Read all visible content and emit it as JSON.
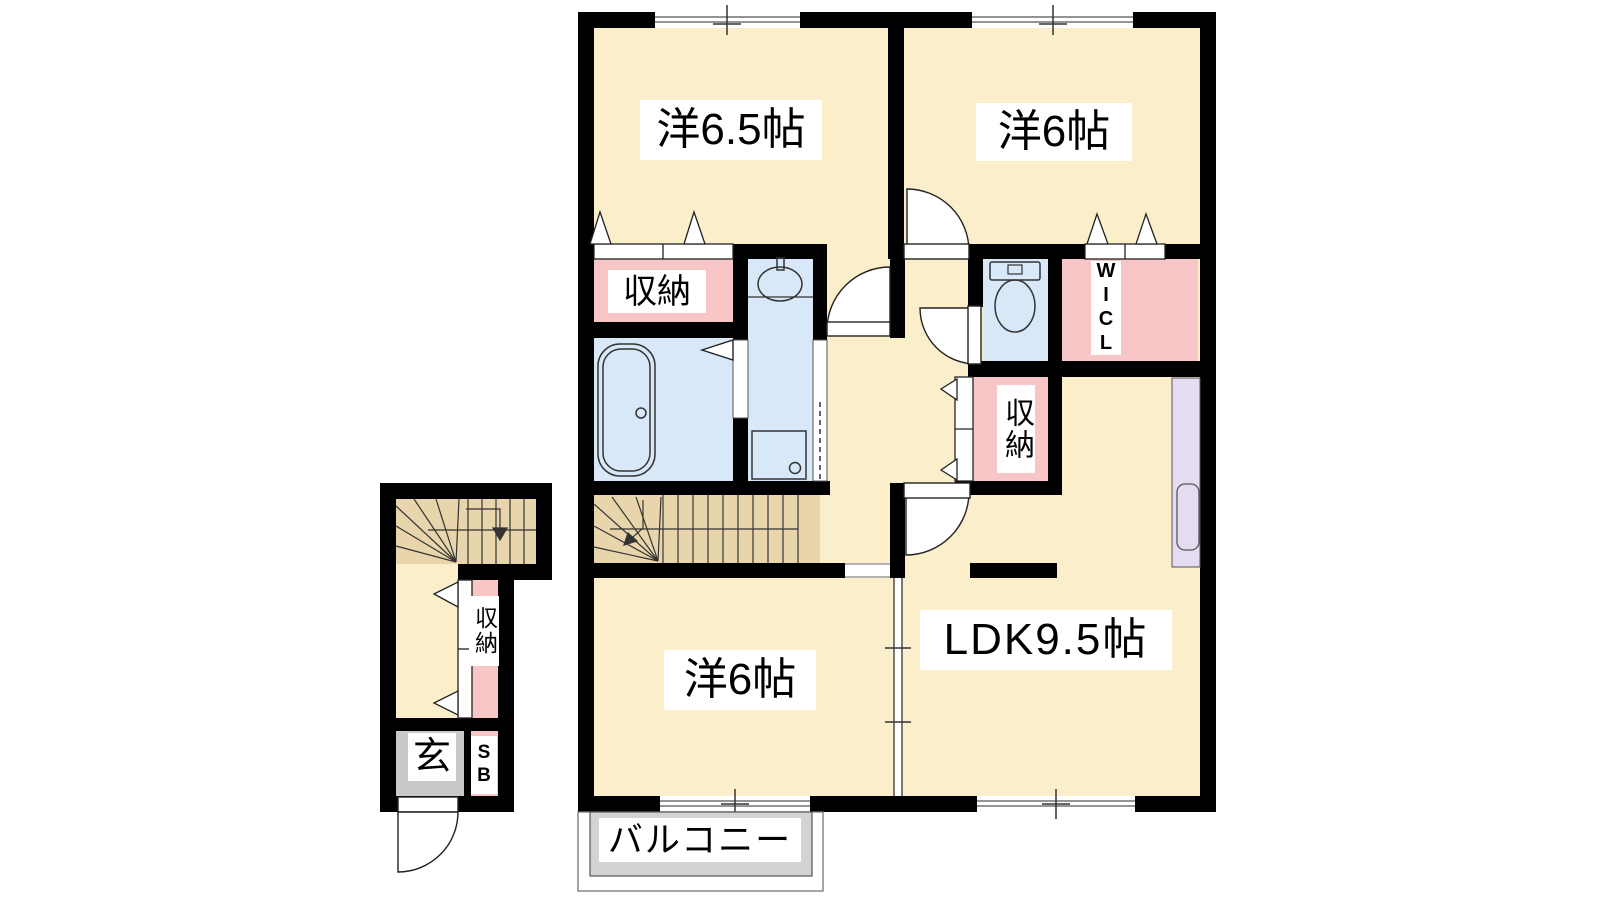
{
  "labels": {
    "bedroom1": "洋6.5帖",
    "bedroom2": "洋6帖",
    "bedroom3": "洋6帖",
    "ldk": "LDK9.5帖",
    "balcony": "バルコニー",
    "closet_bedroom1": "収納",
    "closet_ldk": "収納",
    "closet_hall": "収納",
    "wicl": "WICL",
    "entrance": "玄",
    "shoe_box": "SB"
  },
  "colors": {
    "wall": "#000000",
    "room_floor": "#FBEECB",
    "stairs": "#E9D5AC",
    "closet_pink": "#F9C6C8",
    "wet_area_blue": "#D8E8F8",
    "kitchen_purple": "#E5DCF2",
    "entrance_gray": "#C9C9C9",
    "balcony_gray": "#D3D3D3",
    "line": "#333333"
  }
}
